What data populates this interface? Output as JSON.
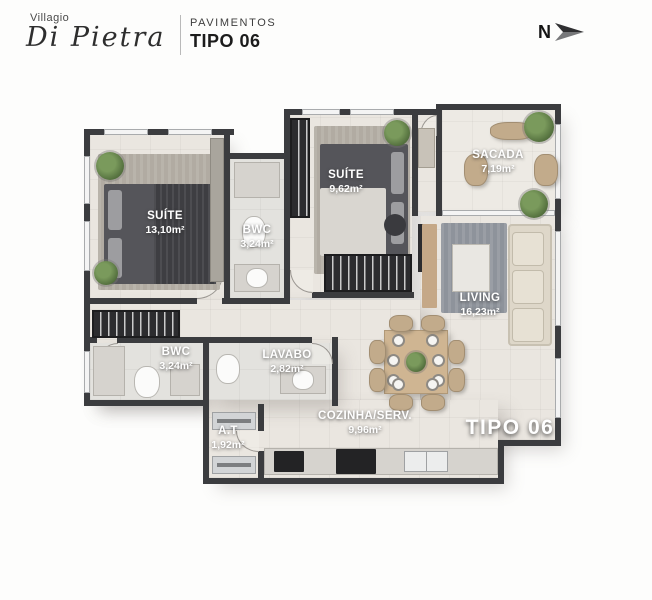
{
  "header": {
    "brand_name": "Villagio",
    "brand_script": "Di Pietra",
    "subtitle_top": "PAVIMENTOS",
    "subtitle_bottom": "TIPO 06"
  },
  "compass": {
    "label": "N"
  },
  "plan": {
    "stamp": "TIPO 06",
    "rooms": {
      "suite1": {
        "name": "SUÍTE",
        "area": "13,10m²"
      },
      "bwc1": {
        "name": "BWC",
        "area": "3,24m²"
      },
      "suite2": {
        "name": "SUÍTE",
        "area": "9,62m²"
      },
      "sacada": {
        "name": "SACADA",
        "area": "7,19m²"
      },
      "living": {
        "name": "LIVING",
        "area": "16,23m²"
      },
      "bwc2": {
        "name": "BWC",
        "area": "3,24m²"
      },
      "lavabo": {
        "name": "LAVABO",
        "area": "2,82m²"
      },
      "at": {
        "name": "A.T",
        "area": "1,92m²"
      },
      "cozinha": {
        "name": "COZINHA/SERV.",
        "area": "9,96m²"
      }
    },
    "colors": {
      "wall": "#3b3c3f",
      "floor": "#eae6e0",
      "bath_floor": "#e3e2de",
      "rug": "#b1aba2",
      "living_rug": "#8e939b",
      "wood": "#c5a887",
      "sofa": "#ded7c9",
      "plant": "#55713f",
      "label_text": "#ffffff"
    }
  }
}
